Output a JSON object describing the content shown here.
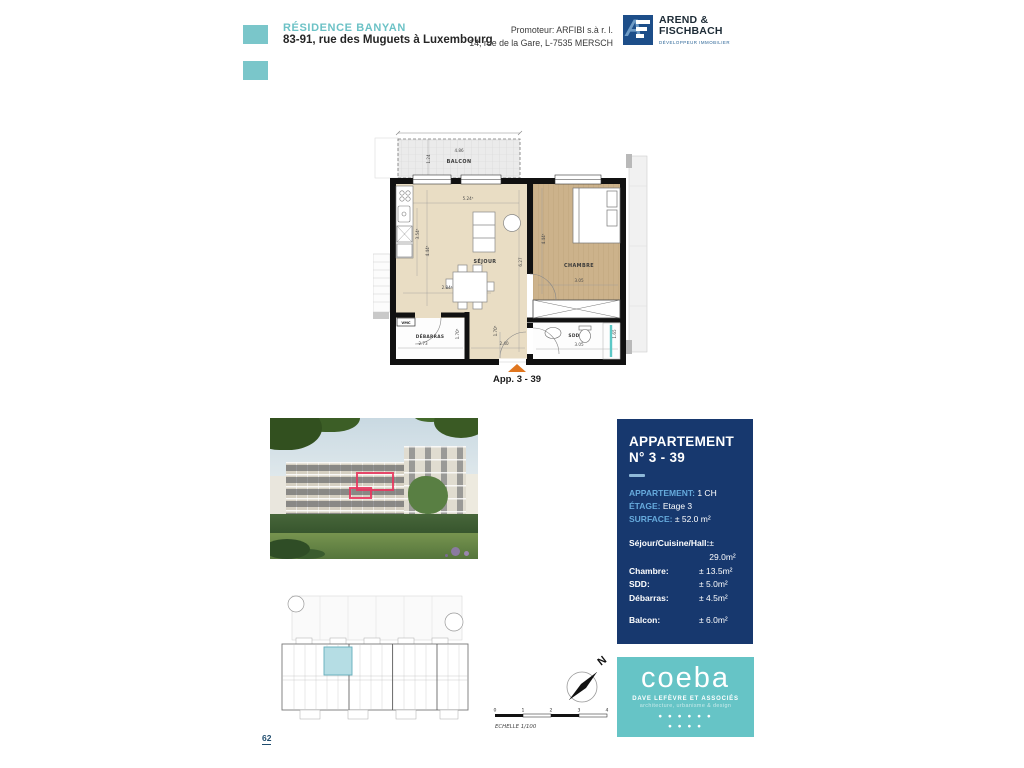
{
  "page": {
    "number": "62"
  },
  "header": {
    "title": "RÉSIDENCE BANYAN",
    "address": "83-91, rue des Muguets à Luxembourg",
    "promoter_line1": "Promoteur: ARFIBI s.à r. l.",
    "promoter_line2": "14, rue de la Gare, L-7535 MERSCH",
    "logo": {
      "monogram": "A",
      "name_line1": "AREND &",
      "name_line2": "FISCHBACH",
      "tagline": "DÉVELOPPEUR IMMOBILIER"
    }
  },
  "floor_plan": {
    "apartment_label": "App. 3 - 39",
    "room_labels": [
      {
        "text": "BALCON",
        "x": 86,
        "y": 37,
        "cls": "room-label"
      },
      {
        "text": "SÉJOUR",
        "x": 112,
        "y": 137,
        "cls": "room-label"
      },
      {
        "text": "CHAMBRE",
        "x": 206,
        "y": 141,
        "cls": "room-label"
      },
      {
        "text": "DÉBARRAS",
        "x": 57,
        "y": 212,
        "cls": "room-label-sm"
      },
      {
        "text": "SDD",
        "x": 201,
        "y": 211,
        "cls": "room-label-sm"
      },
      {
        "text": "VMC",
        "x": 33,
        "y": 198,
        "cls": "vmc-label"
      }
    ],
    "dimensions": [
      {
        "text": "4.86",
        "x": 86,
        "y": 26
      },
      {
        "text": "1.24",
        "x": 57,
        "y": 33,
        "rot": -90
      },
      {
        "text": "5.24⁵",
        "x": 95,
        "y": 74
      },
      {
        "text": "3.54⁵",
        "x": 46,
        "y": 108,
        "rot": -90
      },
      {
        "text": "4.44⁵",
        "x": 56,
        "y": 125,
        "rot": -90
      },
      {
        "text": "2.84⁵",
        "x": 74,
        "y": 163
      },
      {
        "text": "6.27",
        "x": 149,
        "y": 136,
        "rot": -90
      },
      {
        "text": "4.44⁵",
        "x": 172,
        "y": 113,
        "rot": -90
      },
      {
        "text": "3.05",
        "x": 206,
        "y": 156
      },
      {
        "text": "2.73",
        "x": 50,
        "y": 219
      },
      {
        "text": "1.70⁵",
        "x": 86,
        "y": 208,
        "rot": -90
      },
      {
        "text": "2.40",
        "x": 131,
        "y": 219
      },
      {
        "text": "1.70⁵",
        "x": 124,
        "y": 205,
        "rot": -90
      },
      {
        "text": "3.05",
        "x": 206,
        "y": 220
      },
      {
        "text": "1.65",
        "x": 243,
        "y": 208,
        "rot": -90
      }
    ]
  },
  "panel": {
    "title_line1": "APPARTEMENT",
    "title_line2": "N° 3 - 39",
    "info": [
      {
        "label": "APPARTEMENT:",
        "value": "1 CH"
      },
      {
        "label": "ÉTAGE:",
        "value": "Etage 3"
      },
      {
        "label": "SURFACE:",
        "value": "± 52.0 m²"
      }
    ],
    "rooms": [
      {
        "label": "Séjour/Cuisine/Hall:",
        "value": "± 29.0m²"
      },
      {
        "label": "Chambre:",
        "value": "± 13.5m²"
      },
      {
        "label": "SDD:",
        "value": "± 5.0m²"
      },
      {
        "label": "Débarras:",
        "value": "± 4.5m²"
      }
    ],
    "balcony_row": {
      "label": "Balcon:",
      "value": "± 6.0m²"
    }
  },
  "coeba": {
    "name": "coeba",
    "subtitle": "DAVE LEFÈVRE ET ASSOCIÉS",
    "tagline": "architecture, urbanisme & design",
    "dots_row1": "● ● ●   ●   ● ●",
    "dots_row2": "● ●   ● ●"
  },
  "compass": {
    "north_label": "N"
  },
  "scale_bar": {
    "labels": [
      "0",
      "1",
      "2",
      "3",
      "4"
    ],
    "caption": "ECHELLE 1/100"
  },
  "colors": {
    "accent_teal": "#7ac6ca",
    "navy": "#17386e",
    "label_blue": "#66aadc",
    "coeba_teal": "#66c4c6",
    "highlight_red": "#e8375f",
    "entrance_orange": "#e0761f"
  }
}
